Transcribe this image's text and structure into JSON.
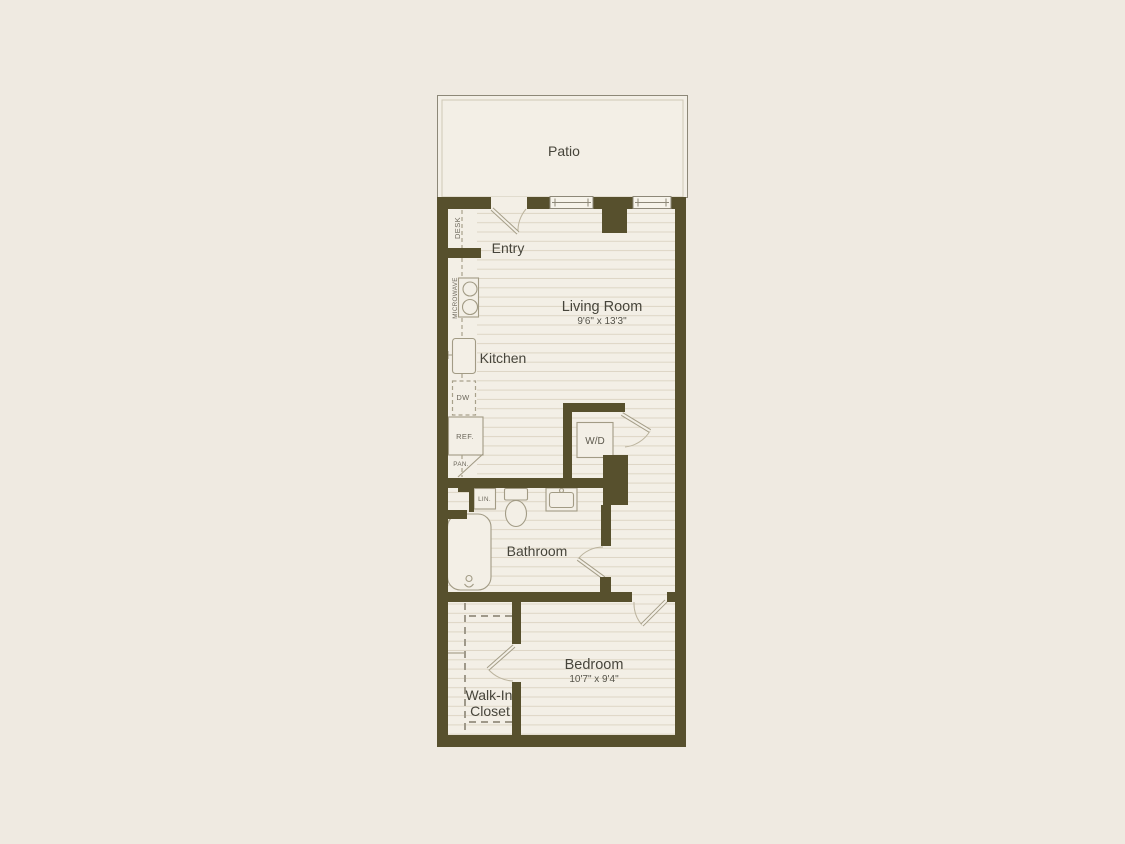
{
  "title": "Apartment floor plan",
  "colors": {
    "background": "#efeae1",
    "floor": "#f3efe6",
    "wall": "#57502d",
    "floor_line": "#ddd6c5",
    "fixture_line": "#a29b85",
    "label_text": "#47453b",
    "small_label_text": "#6b665a"
  },
  "rooms": {
    "patio": {
      "label": "Patio"
    },
    "entry": {
      "label": "Entry"
    },
    "living_room": {
      "label": "Living Room",
      "dimensions": "9'6\" x 13'3\""
    },
    "kitchen": {
      "label": "Kitchen"
    },
    "bathroom": {
      "label": "Bathroom"
    },
    "bedroom": {
      "label": "Bedroom",
      "dimensions": "10'7\" x 9'4\""
    },
    "walk_in_closet": {
      "label_line1": "Walk-In",
      "label_line2": "Closet"
    }
  },
  "fixtures": {
    "desk": {
      "label": "DESK"
    },
    "microwave": {
      "label": "MICROWAVE"
    },
    "dishwasher": {
      "label": "DW"
    },
    "refrigerator": {
      "label": "REF."
    },
    "pantry": {
      "label": "PAN."
    },
    "washer_dryer": {
      "label": "W/D"
    },
    "linen_closet": {
      "label": "LIN."
    }
  }
}
